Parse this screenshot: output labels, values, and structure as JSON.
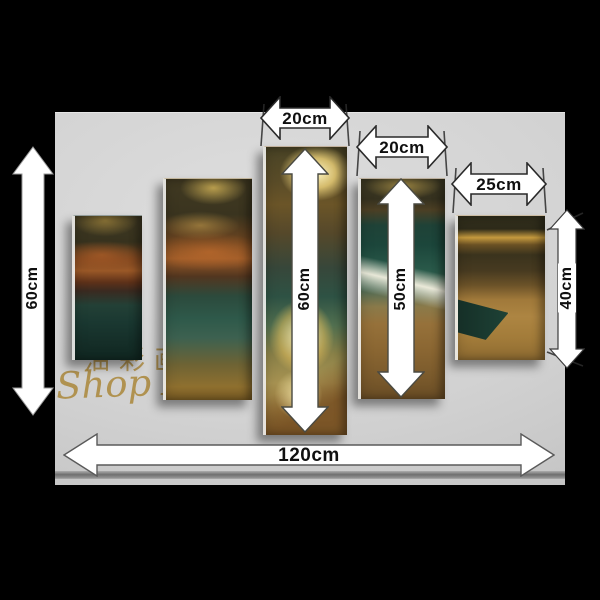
{
  "watermark": {
    "cjk": "油彩画",
    "script": "Shop Art"
  },
  "labels": {
    "panel3_width": "20cm",
    "panel4_width": "20cm",
    "panel5_width": "25cm",
    "panel3_height": "60cm",
    "panel4_height": "50cm",
    "panel5_height": "40cm",
    "set_height": "60cm",
    "set_width": "120cm"
  },
  "colors": {
    "background": "#000000",
    "backdrop_gray": "#d3d3d3",
    "arrow_fill": "#ffffff",
    "arrow_outline": "#3c3c3c",
    "label_text": "#101010",
    "watermark_gold": "#a8822f",
    "sunset_gold": "#d9b050",
    "sea_teal": "#2e594a",
    "sand_brown": "#96713a"
  }
}
